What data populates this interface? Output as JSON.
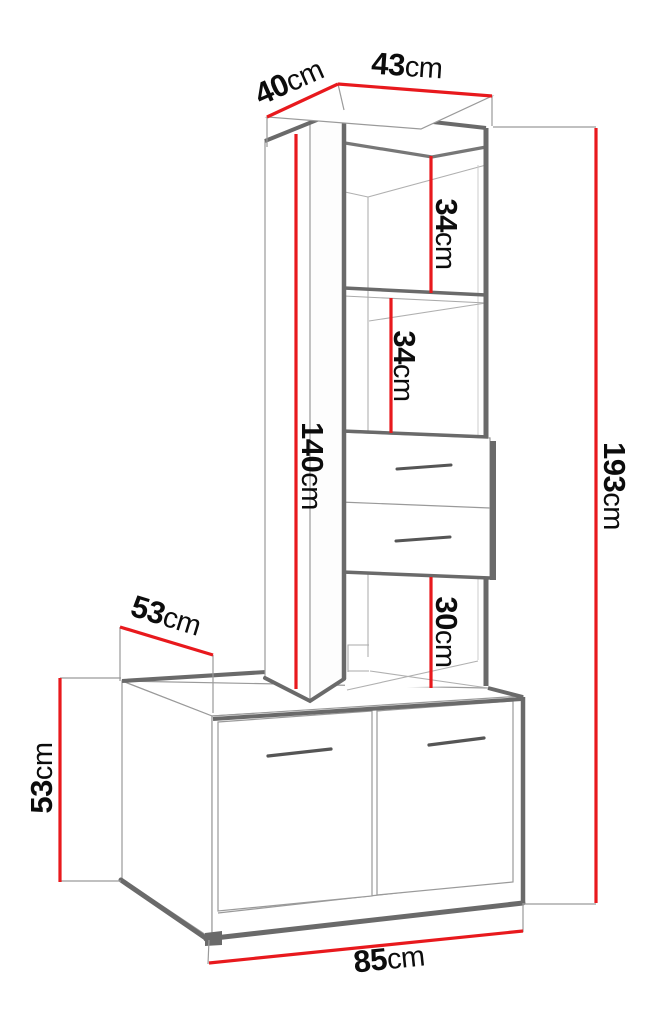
{
  "figure": {
    "type": "furniture-dimension-diagram",
    "unit": "cm",
    "colors": {
      "dimension_line": "#e8191d",
      "outline_dark": "#6a6a6a",
      "outline_light": "#9a9a9a",
      "label_text": "#0c0c0c",
      "background": "#ffffff"
    },
    "dimensions": {
      "top_depth": {
        "value": "40",
        "unit": "cm"
      },
      "top_width": {
        "value": "43",
        "unit": "cm"
      },
      "shelf_gap_upper": {
        "value": "34",
        "unit": "cm"
      },
      "shelf_gap_lower": {
        "value": "34",
        "unit": "cm"
      },
      "tall_unit_height": {
        "value": "140",
        "unit": "cm"
      },
      "total_height": {
        "value": "193",
        "unit": "cm"
      },
      "open_space_height": {
        "value": "30",
        "unit": "cm"
      },
      "base_depth": {
        "value": "53",
        "unit": "cm"
      },
      "base_height": {
        "value": "53",
        "unit": "cm"
      },
      "base_width": {
        "value": "85",
        "unit": "cm"
      }
    }
  }
}
